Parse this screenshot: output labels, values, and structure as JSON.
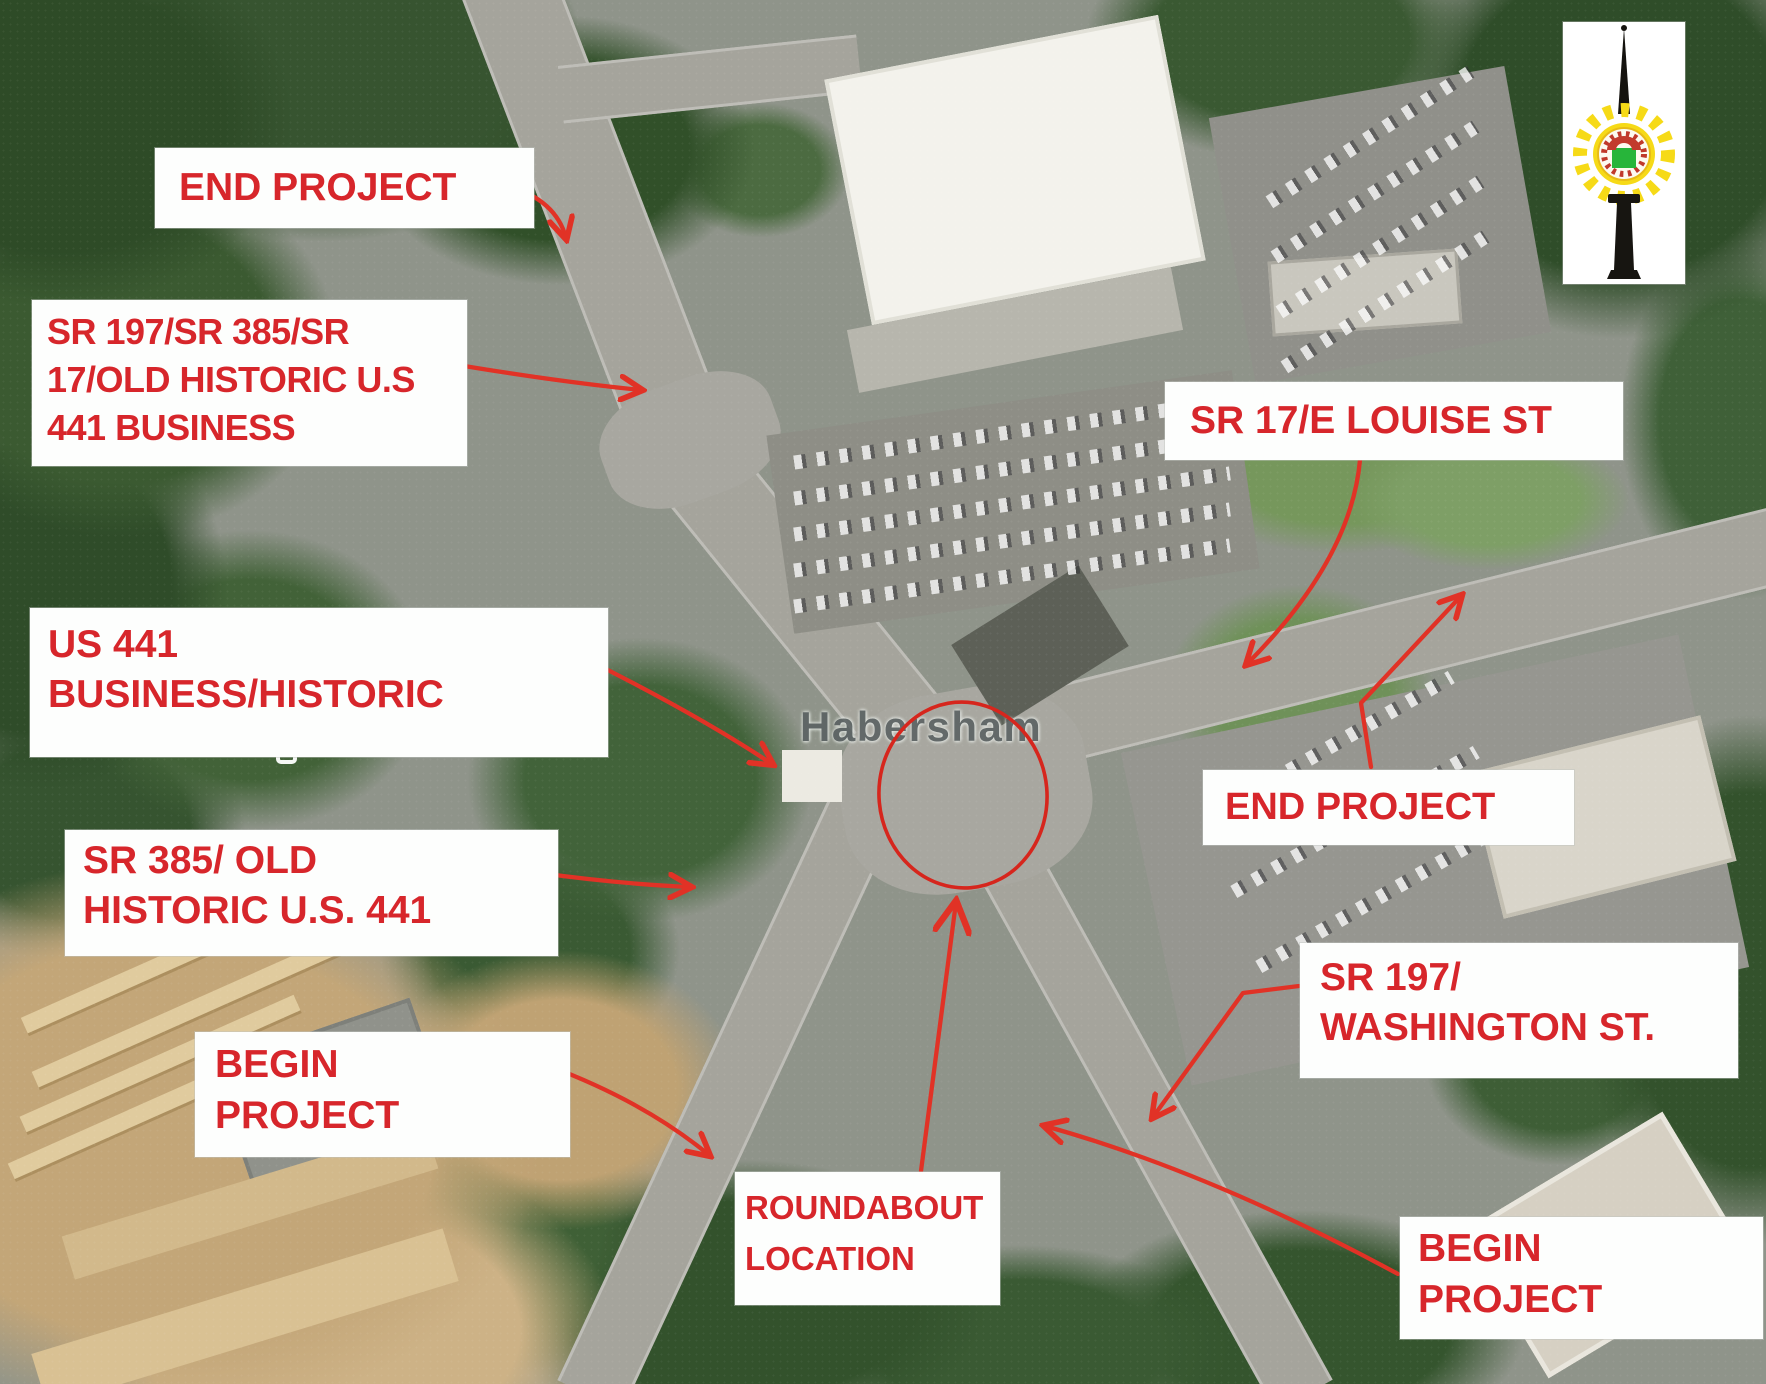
{
  "map": {
    "place_label": "Habersham"
  },
  "logo": {
    "icon": "city-seal-monument-logo"
  },
  "colors": {
    "callout_text": "#d7262b",
    "arrow": "#e13226",
    "roundabout_circle": "#d6261d"
  },
  "callouts": [
    {
      "id": "end-project-northwest",
      "lines": [
        "END PROJECT"
      ]
    },
    {
      "id": "sr197-sr385-sr17-old-historic-us441-business",
      "lines": [
        "SR 197/SR 385/SR",
        "17/OLD HISTORIC U.S",
        "441 BUSINESS"
      ]
    },
    {
      "id": "sr17-e-louise-st",
      "lines": [
        "SR 17/E LOUISE ST"
      ]
    },
    {
      "id": "us441-business-historic",
      "lines": [
        "US 441",
        "BUSINESS/HISTORIC"
      ]
    },
    {
      "id": "end-project-east",
      "lines": [
        "END PROJECT"
      ]
    },
    {
      "id": "sr385-old-historic-us441",
      "lines": [
        "SR 385/ OLD",
        "HISTORIC U.S. 441"
      ]
    },
    {
      "id": "begin-project-west",
      "lines": [
        "BEGIN",
        "PROJECT"
      ]
    },
    {
      "id": "roundabout-location",
      "lines": [
        "ROUNDABOUT",
        "LOCATION"
      ]
    },
    {
      "id": "sr197-washington-st",
      "lines": [
        "SR 197/",
        "WASHINGTON ST."
      ]
    },
    {
      "id": "begin-project-southeast",
      "lines": [
        "BEGIN",
        "PROJECT"
      ]
    }
  ]
}
